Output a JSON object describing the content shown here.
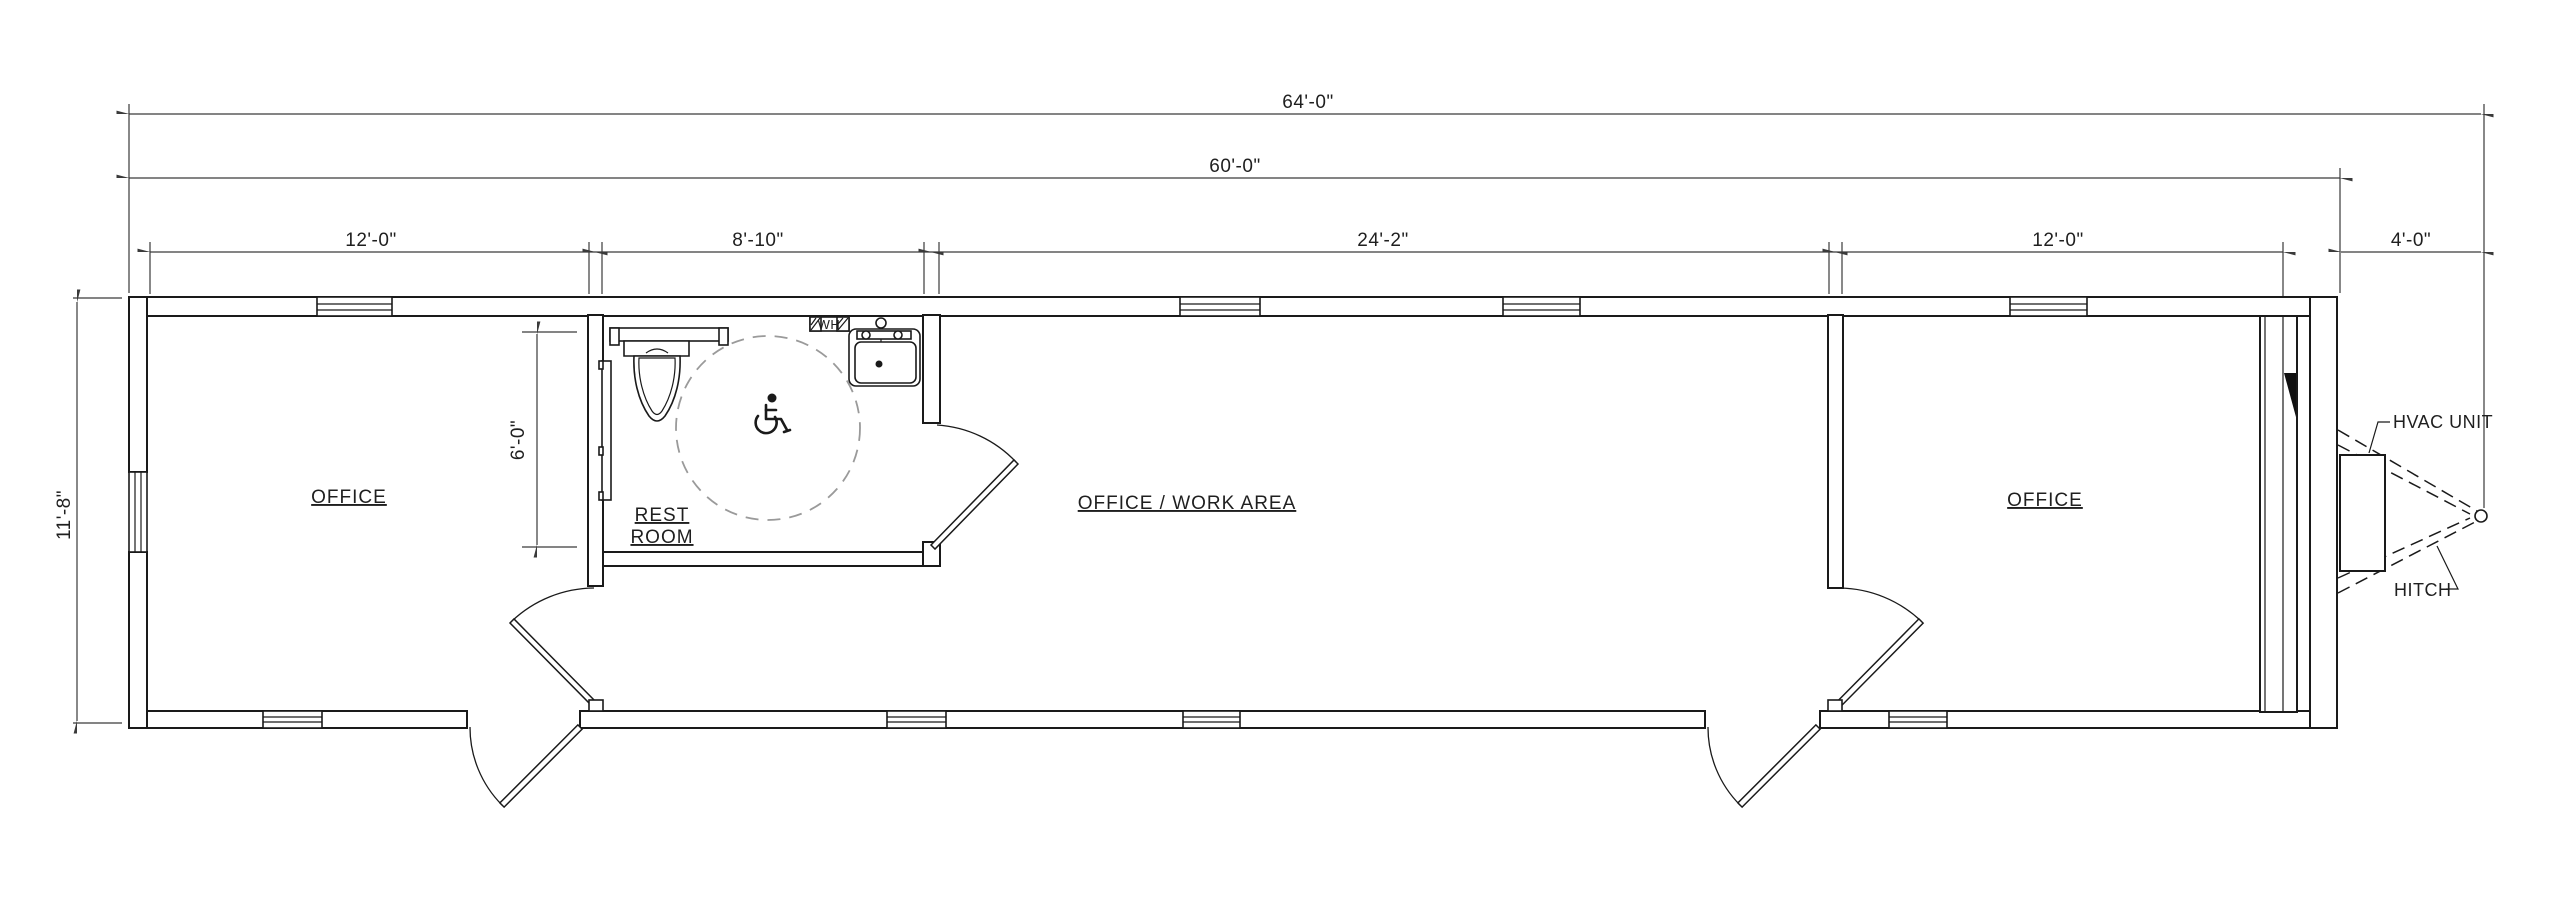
{
  "drawing": {
    "title": "mobile office trailer floor plan",
    "colors": {
      "line": "#1a1a1a",
      "dim": "#3a3a3a",
      "turning_circle_dash": "#9a9a9a",
      "background": "#ffffff"
    },
    "dims": {
      "overall_length": "64'-0\"",
      "body_length": "60'-0\"",
      "width": "11'-8\"",
      "restroom_depth": "6'-0\"",
      "segments": [
        "12'-0\"",
        "8'-10\"",
        "24'-2\"",
        "12'-0\"",
        "4'-0\""
      ]
    },
    "rooms": {
      "office_left": "OFFICE",
      "restroom_line1": "REST",
      "restroom_line2": "ROOM",
      "work_area": "OFFICE / WORK AREA",
      "office_right": "OFFICE"
    },
    "labels": {
      "hvac": "HVAC UNIT",
      "hitch": "HITCH",
      "water_heater": "WH"
    }
  }
}
